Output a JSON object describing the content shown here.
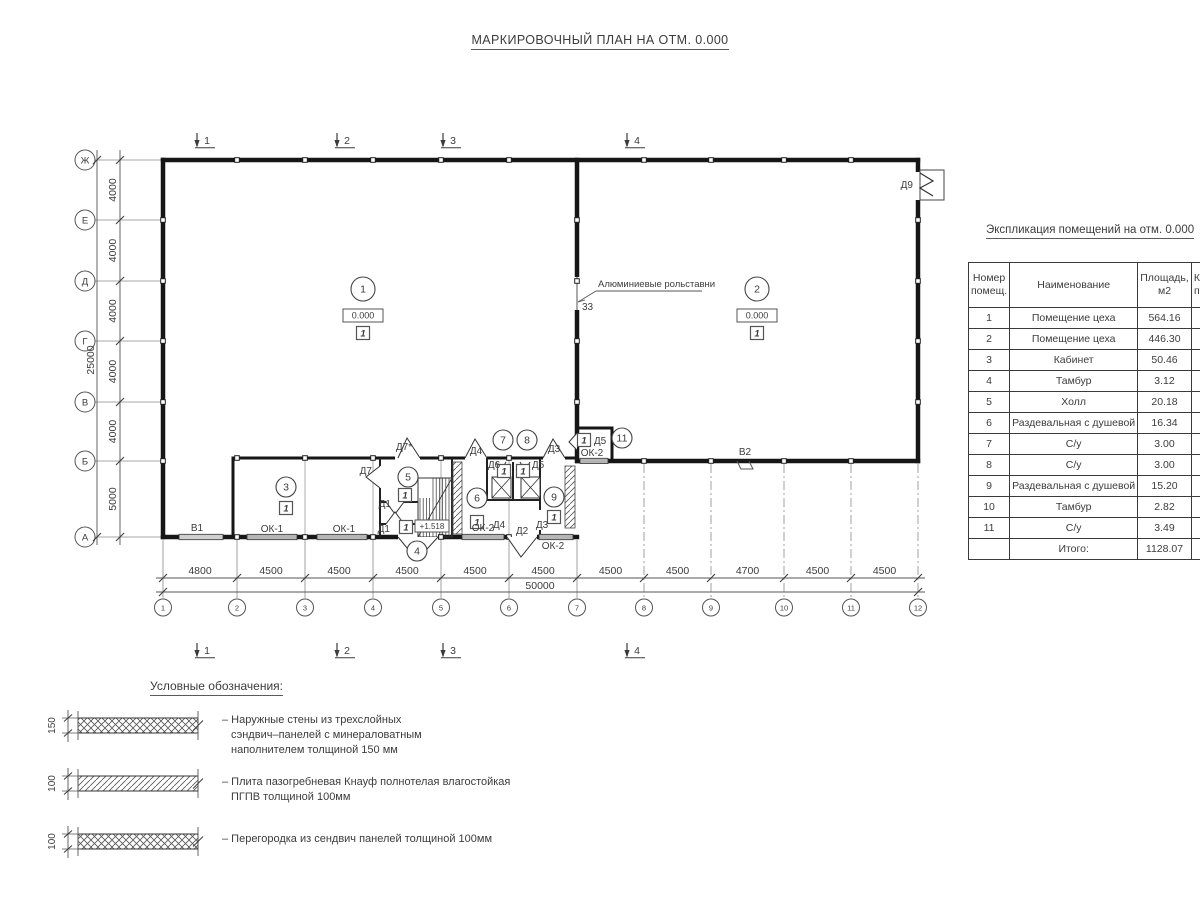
{
  "title": "МАРКИРОВОЧНЫЙ ПЛАН НА ОТМ. 0.000",
  "colors": {
    "ink": "#3c3c3c",
    "thin": "#8a8a8a",
    "wall": "#161616",
    "window_fill": "#b5b5b5",
    "bg": "#ffffff"
  },
  "plan": {
    "section_marks": [
      "1",
      "2",
      "3",
      "4"
    ],
    "axes_bottom": [
      "1",
      "2",
      "3",
      "4",
      "5",
      "6",
      "7",
      "8",
      "9",
      "10",
      "11",
      "12"
    ],
    "axes_left": [
      "Ж",
      "Е",
      "Д",
      "Г",
      "В",
      "Б",
      "А"
    ],
    "dims_bottom": [
      "4800",
      "4500",
      "4500",
      "4500",
      "4500",
      "4500",
      "4500",
      "4500",
      "4700",
      "4500",
      "4500"
    ],
    "dim_total_bottom": "50000",
    "dims_left": [
      "4000",
      "4000",
      "4000",
      "4000",
      "4000",
      "5000"
    ],
    "dim_total_left": "25000",
    "note_text": "Алюминиевые рольставни",
    "note_number": "33",
    "stair_level": "+1.518",
    "level_mark": "0.000",
    "category_mark": "1",
    "room_markers": [
      "1",
      "2",
      "3",
      "4",
      "5",
      "6",
      "7",
      "8",
      "9",
      "11"
    ],
    "door_labels": [
      "Д9",
      "Д7*",
      "Д7",
      "Д1",
      "Д1",
      "Д6",
      "Д5",
      "Д4",
      "Д3",
      "Д5",
      "Д4",
      "Д2",
      "Д3"
    ],
    "window_labels": [
      "ОК-1",
      "ОК-1",
      "ОК-2",
      "ОК-2",
      "ОК-2",
      "В1",
      "В2"
    ]
  },
  "table": {
    "title": "Экспликация помещений на отм. 0.000",
    "headers": {
      "num_line1": "Номер",
      "num_line2": "помещ.",
      "name": "Наименование",
      "area_line1": "Площадь,",
      "area_line2": "м2",
      "cat_line1": "Ка",
      "cat_line2": "по"
    },
    "rows": [
      {
        "num": "1",
        "name": "Помещение цеха",
        "area": "564.16"
      },
      {
        "num": "2",
        "name": "Помещение цеха",
        "area": "446.30"
      },
      {
        "num": "3",
        "name": "Кабинет",
        "area": "50.46"
      },
      {
        "num": "4",
        "name": "Тамбур",
        "area": "3.12"
      },
      {
        "num": "5",
        "name": "Холл",
        "area": "20.18"
      },
      {
        "num": "6",
        "name": "Раздевальная с душевой",
        "area": "16.34"
      },
      {
        "num": "7",
        "name": "С/у",
        "area": "3.00"
      },
      {
        "num": "8",
        "name": "С/у",
        "area": "3.00"
      },
      {
        "num": "9",
        "name": "Раздевальная с душевой",
        "area": "15.20"
      },
      {
        "num": "10",
        "name": "Тамбур",
        "area": "2.82"
      },
      {
        "num": "11",
        "name": "С/у",
        "area": "3.49"
      }
    ],
    "total_label": "Итого:",
    "total_value": "1128.07"
  },
  "legend": {
    "title": "Условные обозначения:",
    "items": [
      {
        "dim": "150",
        "hatch": "cross",
        "lines": [
          "– Наружные стены из трехслойных",
          "сэндвич–панелей с минераловатным",
          "наполнителем толщиной 150 мм"
        ]
      },
      {
        "dim": "100",
        "hatch": "diag",
        "lines": [
          "– Плита пазогребневая Кнауф полнотелая влагостойкая",
          "ПГПВ толщиной 100мм"
        ]
      },
      {
        "dim": "100",
        "hatch": "cross",
        "lines": [
          "– Перегородка из сендвич панелей толщиной 100мм"
        ]
      }
    ]
  }
}
